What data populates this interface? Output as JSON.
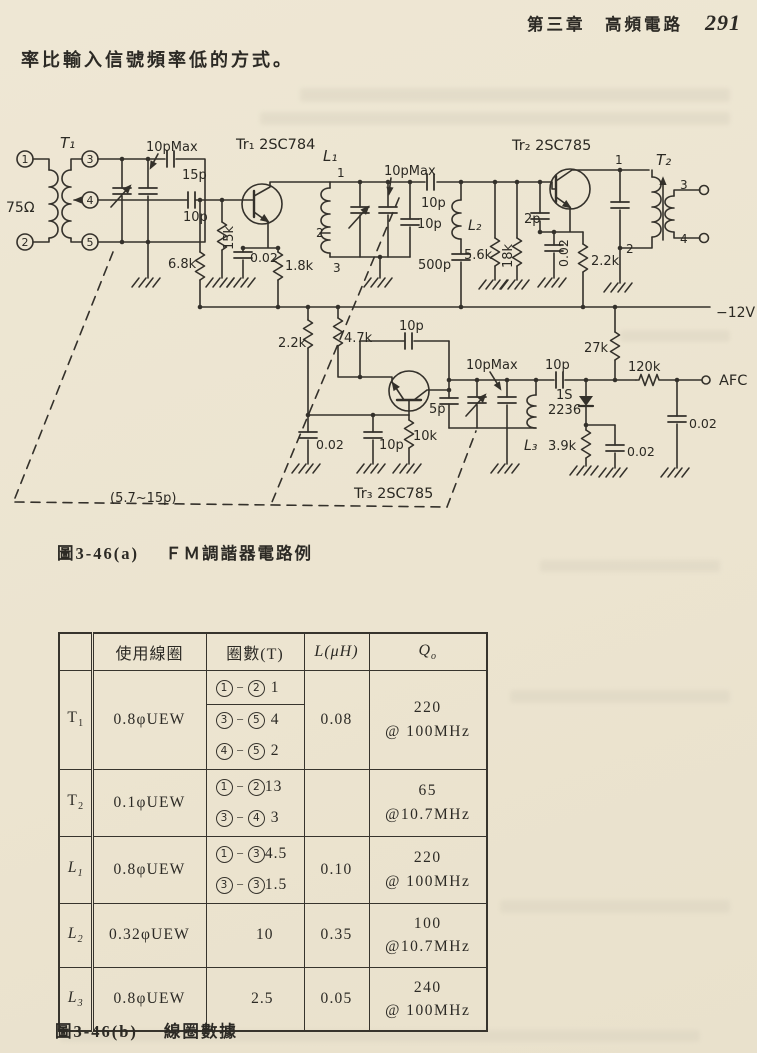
{
  "page": {
    "header": {
      "chapter_title": "第三章　高頻電路",
      "page_number": "291"
    },
    "intro_text": "率比輸入信號頻率低的方式。",
    "figure_a": {
      "label": "圖3-46(a)",
      "title": "ＦＭ調諧器電路例"
    },
    "figure_b": {
      "label": "圖3-46(b)",
      "title": "線圈數據"
    }
  },
  "circuit": {
    "labels": [
      {
        "id": "terminal-1-label",
        "t": "1",
        "x": 25,
        "y": 163,
        "fs": 11,
        "anchor": "middle"
      },
      {
        "id": "terminal-2-label",
        "t": "2",
        "x": 25,
        "y": 246,
        "fs": 11,
        "anchor": "middle"
      },
      {
        "id": "terminal-3-label",
        "t": "3",
        "x": 90,
        "y": 163,
        "fs": 11,
        "anchor": "middle"
      },
      {
        "id": "terminal-4-label",
        "t": "4",
        "x": 90,
        "y": 204,
        "fs": 11,
        "anchor": "middle"
      },
      {
        "id": "terminal-5-label",
        "t": "5",
        "x": 90,
        "y": 246,
        "fs": 11,
        "anchor": "middle"
      },
      {
        "id": "label-input-impedance",
        "t": "75Ω",
        "x": 6,
        "y": 212,
        "fs": 14
      },
      {
        "id": "label-t1",
        "t": "T₁",
        "x": 60,
        "y": 148,
        "fs": 15,
        "it": 1
      },
      {
        "id": "label-cap-10pmax-1",
        "t": "10pMax",
        "x": 146,
        "y": 151,
        "fs": 13
      },
      {
        "id": "label-cap-15p",
        "t": "15p",
        "x": 182,
        "y": 179,
        "fs": 13
      },
      {
        "id": "label-cap-10p-t1",
        "t": "10p",
        "x": 183,
        "y": 221,
        "fs": 13
      },
      {
        "id": "label-tr1",
        "t": "Tr₁ 2SC784",
        "x": 236,
        "y": 149,
        "fs": 14.5
      },
      {
        "id": "label-res-68k",
        "t": "6.8k",
        "x": 168,
        "y": 268,
        "fs": 13
      },
      {
        "id": "label-res-15k",
        "t": "15k",
        "x": 233,
        "y": 250,
        "fs": 13,
        "rot": -90
      },
      {
        "id": "label-cap-002-1",
        "t": "0.02",
        "x": 250,
        "y": 262,
        "fs": 12.5
      },
      {
        "id": "label-res-18k-1",
        "t": "1.8k",
        "x": 285,
        "y": 270,
        "fs": 13
      },
      {
        "id": "label-l1",
        "t": "L₁",
        "x": 323,
        "y": 161,
        "fs": 15,
        "it": 1
      },
      {
        "id": "label-l1-tap1",
        "t": "1",
        "x": 337,
        "y": 177,
        "fs": 12
      },
      {
        "id": "label-l1-tap2",
        "t": "2",
        "x": 316,
        "y": 237,
        "fs": 12
      },
      {
        "id": "label-l1-tap3",
        "t": "3",
        "x": 333,
        "y": 272,
        "fs": 12
      },
      {
        "id": "label-cap-10pmax-2",
        "t": "10pMax",
        "x": 384,
        "y": 175,
        "fs": 13
      },
      {
        "id": "label-cap-10p-series",
        "t": "10p",
        "x": 421,
        "y": 207,
        "fs": 13
      },
      {
        "id": "label-cap-10p-shunt",
        "t": "10p",
        "x": 417,
        "y": 228,
        "fs": 13
      },
      {
        "id": "label-l2",
        "t": "L₂",
        "x": 468,
        "y": 230,
        "fs": 14,
        "it": 1
      },
      {
        "id": "label-res-56k",
        "t": "5.6k",
        "x": 464,
        "y": 259,
        "fs": 13
      },
      {
        "id": "label-cap-500p",
        "t": "500p",
        "x": 418,
        "y": 269,
        "fs": 13
      },
      {
        "id": "label-res-18k-2",
        "t": "18k",
        "x": 512,
        "y": 268,
        "fs": 13,
        "rot": -90
      },
      {
        "id": "label-tr2",
        "t": "Tr₂ 2SC785",
        "x": 512,
        "y": 150,
        "fs": 14.5
      },
      {
        "id": "label-cap-2p",
        "t": "2p",
        "x": 524,
        "y": 223,
        "fs": 13
      },
      {
        "id": "label-cap-002-2",
        "t": "0.02",
        "x": 568,
        "y": 267,
        "fs": 12.5,
        "rot": -90
      },
      {
        "id": "label-res-22k-tr2",
        "t": "2.2k",
        "x": 591,
        "y": 265,
        "fs": 13
      },
      {
        "id": "label-t2",
        "t": "T₂",
        "x": 656,
        "y": 165,
        "fs": 15,
        "it": 1
      },
      {
        "id": "label-t2-tap1",
        "t": "1",
        "x": 615,
        "y": 164,
        "fs": 12
      },
      {
        "id": "label-t2-tap2",
        "t": "2",
        "x": 626,
        "y": 253,
        "fs": 12
      },
      {
        "id": "label-t2-tap3",
        "t": "3",
        "x": 680,
        "y": 189,
        "fs": 12
      },
      {
        "id": "label-t2-tap4",
        "t": "4",
        "x": 680,
        "y": 243,
        "fs": 12
      },
      {
        "id": "label-supply",
        "t": "−12V",
        "x": 716,
        "y": 317,
        "fs": 14
      },
      {
        "id": "label-res-22k-osc",
        "t": "2.2k",
        "x": 278,
        "y": 347,
        "fs": 13
      },
      {
        "id": "label-res-47k",
        "t": "4.7k",
        "x": 344,
        "y": 342,
        "fs": 13
      },
      {
        "id": "label-cap-10p-fb",
        "t": "10p",
        "x": 399,
        "y": 330,
        "fs": 13
      },
      {
        "id": "label-cap-10pmax-3",
        "t": "10pMax",
        "x": 466,
        "y": 369,
        "fs": 13
      },
      {
        "id": "label-cap-10p-afc",
        "t": "10p",
        "x": 545,
        "y": 369,
        "fs": 13
      },
      {
        "id": "label-diode-1s",
        "t": "1S",
        "x": 556,
        "y": 399,
        "fs": 13
      },
      {
        "id": "label-diode-2236",
        "t": "2236",
        "x": 548,
        "y": 414,
        "fs": 13
      },
      {
        "id": "label-res-27k",
        "t": "27k",
        "x": 584,
        "y": 352,
        "fs": 13
      },
      {
        "id": "label-res-120k",
        "t": "120k",
        "x": 628,
        "y": 371,
        "fs": 13
      },
      {
        "id": "label-afc",
        "t": "AFC",
        "x": 719,
        "y": 385,
        "fs": 14.5
      },
      {
        "id": "label-cap-002-afc",
        "t": "0.02",
        "x": 689,
        "y": 428,
        "fs": 12.5
      },
      {
        "id": "label-cap-002-diode",
        "t": "0.02",
        "x": 627,
        "y": 456,
        "fs": 12.5
      },
      {
        "id": "label-res-39k",
        "t": "3.9k",
        "x": 548,
        "y": 450,
        "fs": 13
      },
      {
        "id": "label-l3",
        "t": "L₃",
        "x": 524,
        "y": 450,
        "fs": 14,
        "it": 1
      },
      {
        "id": "label-res-10k",
        "t": "10k",
        "x": 413,
        "y": 440,
        "fs": 13
      },
      {
        "id": "label-cap-10p-osc",
        "t": "10p",
        "x": 379,
        "y": 449,
        "fs": 13
      },
      {
        "id": "label-cap-002-osc",
        "t": "0.02",
        "x": 316,
        "y": 449,
        "fs": 12.5
      },
      {
        "id": "label-cap-5p",
        "t": "5p",
        "x": 429,
        "y": 413,
        "fs": 13
      },
      {
        "id": "label-tr3",
        "t": "Tr₃ 2SC785",
        "x": 354,
        "y": 498,
        "fs": 14.5
      },
      {
        "id": "label-gang-range",
        "t": "(5.7~15p)",
        "x": 110,
        "y": 502,
        "fs": 13
      }
    ]
  },
  "table": {
    "pair_dash": "−",
    "headers": {
      "coil": "使用線圈",
      "turns": "圈數(T)",
      "l": "L(μH)",
      "q_base": "Q",
      "q_sub": "o"
    },
    "rows": [
      {
        "name": {
          "base": "T",
          "sub": "1"
        },
        "coil": "0.8φUEW",
        "turns": [
          {
            "a": "1",
            "b": "2",
            "n": "1"
          },
          {
            "a": "3",
            "b": "5",
            "n": "4"
          },
          {
            "a": "4",
            "b": "5",
            "n": "2"
          }
        ],
        "l": "0.08",
        "q1": "220",
        "q2": "@ 100MHz"
      },
      {
        "name": {
          "base": "T",
          "sub": "2"
        },
        "coil": "0.1φUEW",
        "turns": [
          {
            "a": "1",
            "b": "2",
            "n": "13"
          },
          {
            "a": "3",
            "b": "4",
            "n": "3"
          }
        ],
        "l": "",
        "q1": "65",
        "q2": "@10.7MHz"
      },
      {
        "name": {
          "base": "L",
          "sub": "1"
        },
        "coil": "0.8φUEW",
        "turns": [
          {
            "a": "1",
            "b": "3",
            "n": "4.5"
          },
          {
            "a": "3",
            "b": "3",
            "n": "1.5"
          }
        ],
        "l": "0.10",
        "q1": "220",
        "q2": "@ 100MHz"
      },
      {
        "name": {
          "base": "L",
          "sub": "2"
        },
        "coil": "0.32φUEW",
        "turns": [
          {
            "n": "10"
          }
        ],
        "l": "0.35",
        "q1": "100",
        "q2": "@10.7MHz"
      },
      {
        "name": {
          "base": "L",
          "sub": "3"
        },
        "coil": "0.8φUEW",
        "turns": [
          {
            "n": "2.5"
          }
        ],
        "l": "0.05",
        "q1": "240",
        "q2": "@ 100MHz"
      }
    ]
  }
}
